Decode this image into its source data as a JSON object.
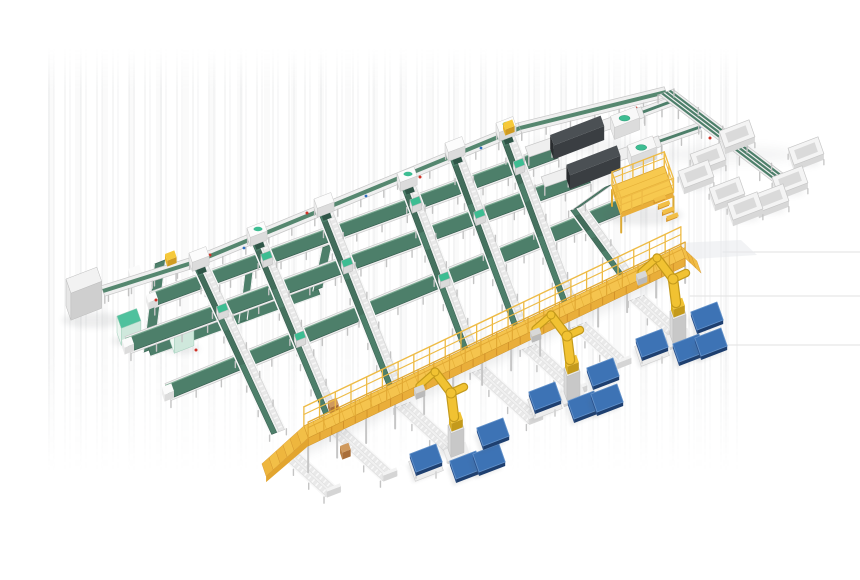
{
  "meta": {
    "canvas_width": 860,
    "canvas_height": 580,
    "background": "#ffffff"
  },
  "palette": {
    "green": "#4d7f6a",
    "green_dark": "#2f5648",
    "green_edge": "#3c6a57",
    "green_light": "#7fae96",
    "teal": "#3dbd92",
    "teal_dark": "#2a9874",
    "frame": "#efefef",
    "frame_hi": "#fafafa",
    "frame_edge": "#c6c6c6",
    "frame_mid": "#dedede",
    "leg": "#c4c4c4",
    "roller": "#e7e7e7",
    "yellow_deck": "#f5c44e",
    "yellow_face": "#e9ae3a",
    "yellow_deep": "#d3932a",
    "yellow_rail": "#eebb45",
    "robot": "#f1c232",
    "robot_shade": "#c49a1b",
    "blue_top": "#3d73b5",
    "blue_edge": "#6392ca",
    "blue_left": "#2b528c",
    "blue_right": "#1e3f6f",
    "dark_top": "#4b5054",
    "dark_left": "#292c2f",
    "dark_front": "#3a3e42",
    "parcel": "#d09a5e",
    "parcel_side": "#a96e39",
    "red": "#cf3226",
    "blue_dot": "#2f6fbe",
    "shadow": "#565b60",
    "ghost": "#e8eaec",
    "floor_line": "#e2e2e2"
  },
  "scene": {
    "floor_lines": [
      [
        723,
        252,
        860,
        252
      ],
      [
        690,
        296,
        860,
        296
      ],
      [
        718,
        345,
        860,
        345
      ]
    ],
    "ghost_patch": [
      [
        678,
        243
      ],
      [
        741,
        240
      ],
      [
        757,
        255
      ],
      [
        694,
        259
      ]
    ],
    "loop_strips": [
      {
        "p1": [
          160,
          262
        ],
        "p2": [
          149,
          350
        ],
        "w": 12
      },
      {
        "p1": [
          149,
          350
        ],
        "p2": [
          318,
          289
        ],
        "w": 13
      },
      {
        "p1": [
          318,
          289
        ],
        "p2": [
          327,
          246
        ],
        "w": 11
      },
      {
        "p1": [
          243,
          321
        ],
        "p2": [
          250,
          264
        ],
        "w": 9
      }
    ],
    "cabinet": {
      "o": [
        66,
        306
      ],
      "da": 33,
      "db": 15,
      "h": 27
    },
    "connector": {
      "p1": [
        107,
        290
      ],
      "p2": [
        176,
        267
      ],
      "w": 9
    },
    "connector_box": [
      128,
      277
    ],
    "process_units": [
      {
        "o": [
          117,
          333
        ],
        "da": 21,
        "db": 13,
        "h": 17
      },
      {
        "o": [
          170,
          341
        ],
        "da": 21,
        "db": 13,
        "h": 17
      }
    ],
    "infeed_points": [
      [
        103,
        291
      ],
      [
        198,
        261
      ],
      [
        520,
        128
      ],
      [
        666,
        92
      ]
    ],
    "infeed_width": 11,
    "line_heads": [
      [
        198,
        260
      ],
      [
        256,
        235
      ],
      [
        323,
        206
      ],
      [
        406,
        180
      ],
      [
        454,
        150
      ],
      [
        505,
        130
      ]
    ],
    "head_teal": [
      1,
      3,
      5
    ],
    "totes": [
      [
        170,
        257
      ],
      [
        508,
        126
      ]
    ],
    "sorter_lines": [
      {
        "t": [
          198,
          260
        ],
        "e": [
          278,
          432
        ]
      },
      {
        "t": [
          256,
          235
        ],
        "e": [
          330,
          412
        ]
      },
      {
        "t": [
          323,
          206
        ],
        "e": [
          394,
          385
        ]
      },
      {
        "t": [
          406,
          180
        ],
        "e": [
          470,
          350
        ]
      },
      {
        "t": [
          454,
          150
        ],
        "e": [
          520,
          327
        ]
      },
      {
        "t": [
          505,
          130
        ],
        "e": [
          570,
          305
        ]
      },
      {
        "t": [
          577,
          208
        ],
        "e": [
          628,
          278
        ]
      }
    ],
    "cross_belts": [
      {
        "p1": [
          152,
          300
        ],
        "p2": [
          556,
          152
        ],
        "w": 13
      },
      {
        "p1": [
          128,
          345
        ],
        "p2": [
          588,
          176
        ],
        "w": 14
      },
      {
        "p1": [
          168,
          392
        ],
        "p2": [
          622,
          206
        ],
        "w": 14
      }
    ],
    "cap_pairs": [
      [
        1,
        0
      ],
      [
        3,
        0
      ],
      [
        5,
        0
      ],
      [
        0,
        1
      ],
      [
        2,
        1
      ],
      [
        4,
        1
      ],
      [
        1,
        2
      ],
      [
        3,
        2
      ]
    ],
    "dws_strips": [
      {
        "p1": [
          527,
          152
        ],
        "p2": [
          643,
          112
        ]
      },
      {
        "p1": [
          543,
          182
        ],
        "p2": [
          660,
          141
        ]
      }
    ],
    "dws_stubs": [
      {
        "p1": [
          643,
          112
        ],
        "p2": [
          678,
          99
        ],
        "w": 9
      },
      {
        "p1": [
          660,
          141
        ],
        "p2": [
          700,
          127
        ],
        "w": 9
      }
    ],
    "dws_outfeed": {
      "p1": [
        608,
        186
      ],
      "p2": [
        577,
        208
      ],
      "w": 11
    },
    "right_line": {
      "p1": [
        666,
        92
      ],
      "p2": [
        788,
        185
      ],
      "w": 15
    },
    "bins": [
      [
        737,
        140
      ],
      [
        806,
        157
      ],
      [
        708,
        163
      ],
      [
        696,
        180
      ],
      [
        727,
        197
      ],
      [
        790,
        186
      ],
      [
        771,
        204
      ],
      [
        745,
        212
      ]
    ],
    "platform": {
      "o": [
        612,
        206
      ],
      "da": 56,
      "db": 28,
      "h": 20,
      "rail": 14
    },
    "walkway": {
      "s": [
        306,
        432
      ],
      "e": [
        683,
        252
      ],
      "hw": 6.5,
      "deck_h": 8,
      "rail_h": 19,
      "leg_h": 26,
      "steps_left": 6,
      "steps_right": 3
    },
    "chute_dir": [
      0.74,
      0.673
    ],
    "chute_lens": [
      62,
      68,
      72,
      76,
      68,
      60,
      52
    ],
    "robots": [
      [
        455,
        448
      ],
      [
        571,
        391
      ],
      [
        677,
        334
      ]
    ],
    "pallet_stands": [
      [
        426,
        466
      ],
      [
        545,
        404
      ],
      [
        652,
        351
      ]
    ],
    "pallets": [
      [
        466,
        469
      ],
      [
        489,
        462
      ],
      [
        493,
        436
      ],
      [
        584,
        409
      ],
      [
        607,
        402
      ],
      [
        603,
        376
      ],
      [
        689,
        352
      ],
      [
        711,
        346
      ],
      [
        707,
        320
      ]
    ],
    "parcels": [
      [
        344,
        450
      ],
      [
        332,
        405
      ]
    ],
    "red_dots": [
      [
        210,
        255
      ],
      [
        307,
        213
      ],
      [
        420,
        177
      ],
      [
        560,
        146
      ],
      [
        710,
        138
      ],
      [
        156,
        300
      ],
      [
        196,
        350
      ],
      [
        636,
        108
      ],
      [
        652,
        138
      ]
    ],
    "blue_dots": [
      [
        700,
        127
      ],
      [
        244,
        248
      ],
      [
        366,
        196
      ],
      [
        481,
        148
      ]
    ]
  }
}
